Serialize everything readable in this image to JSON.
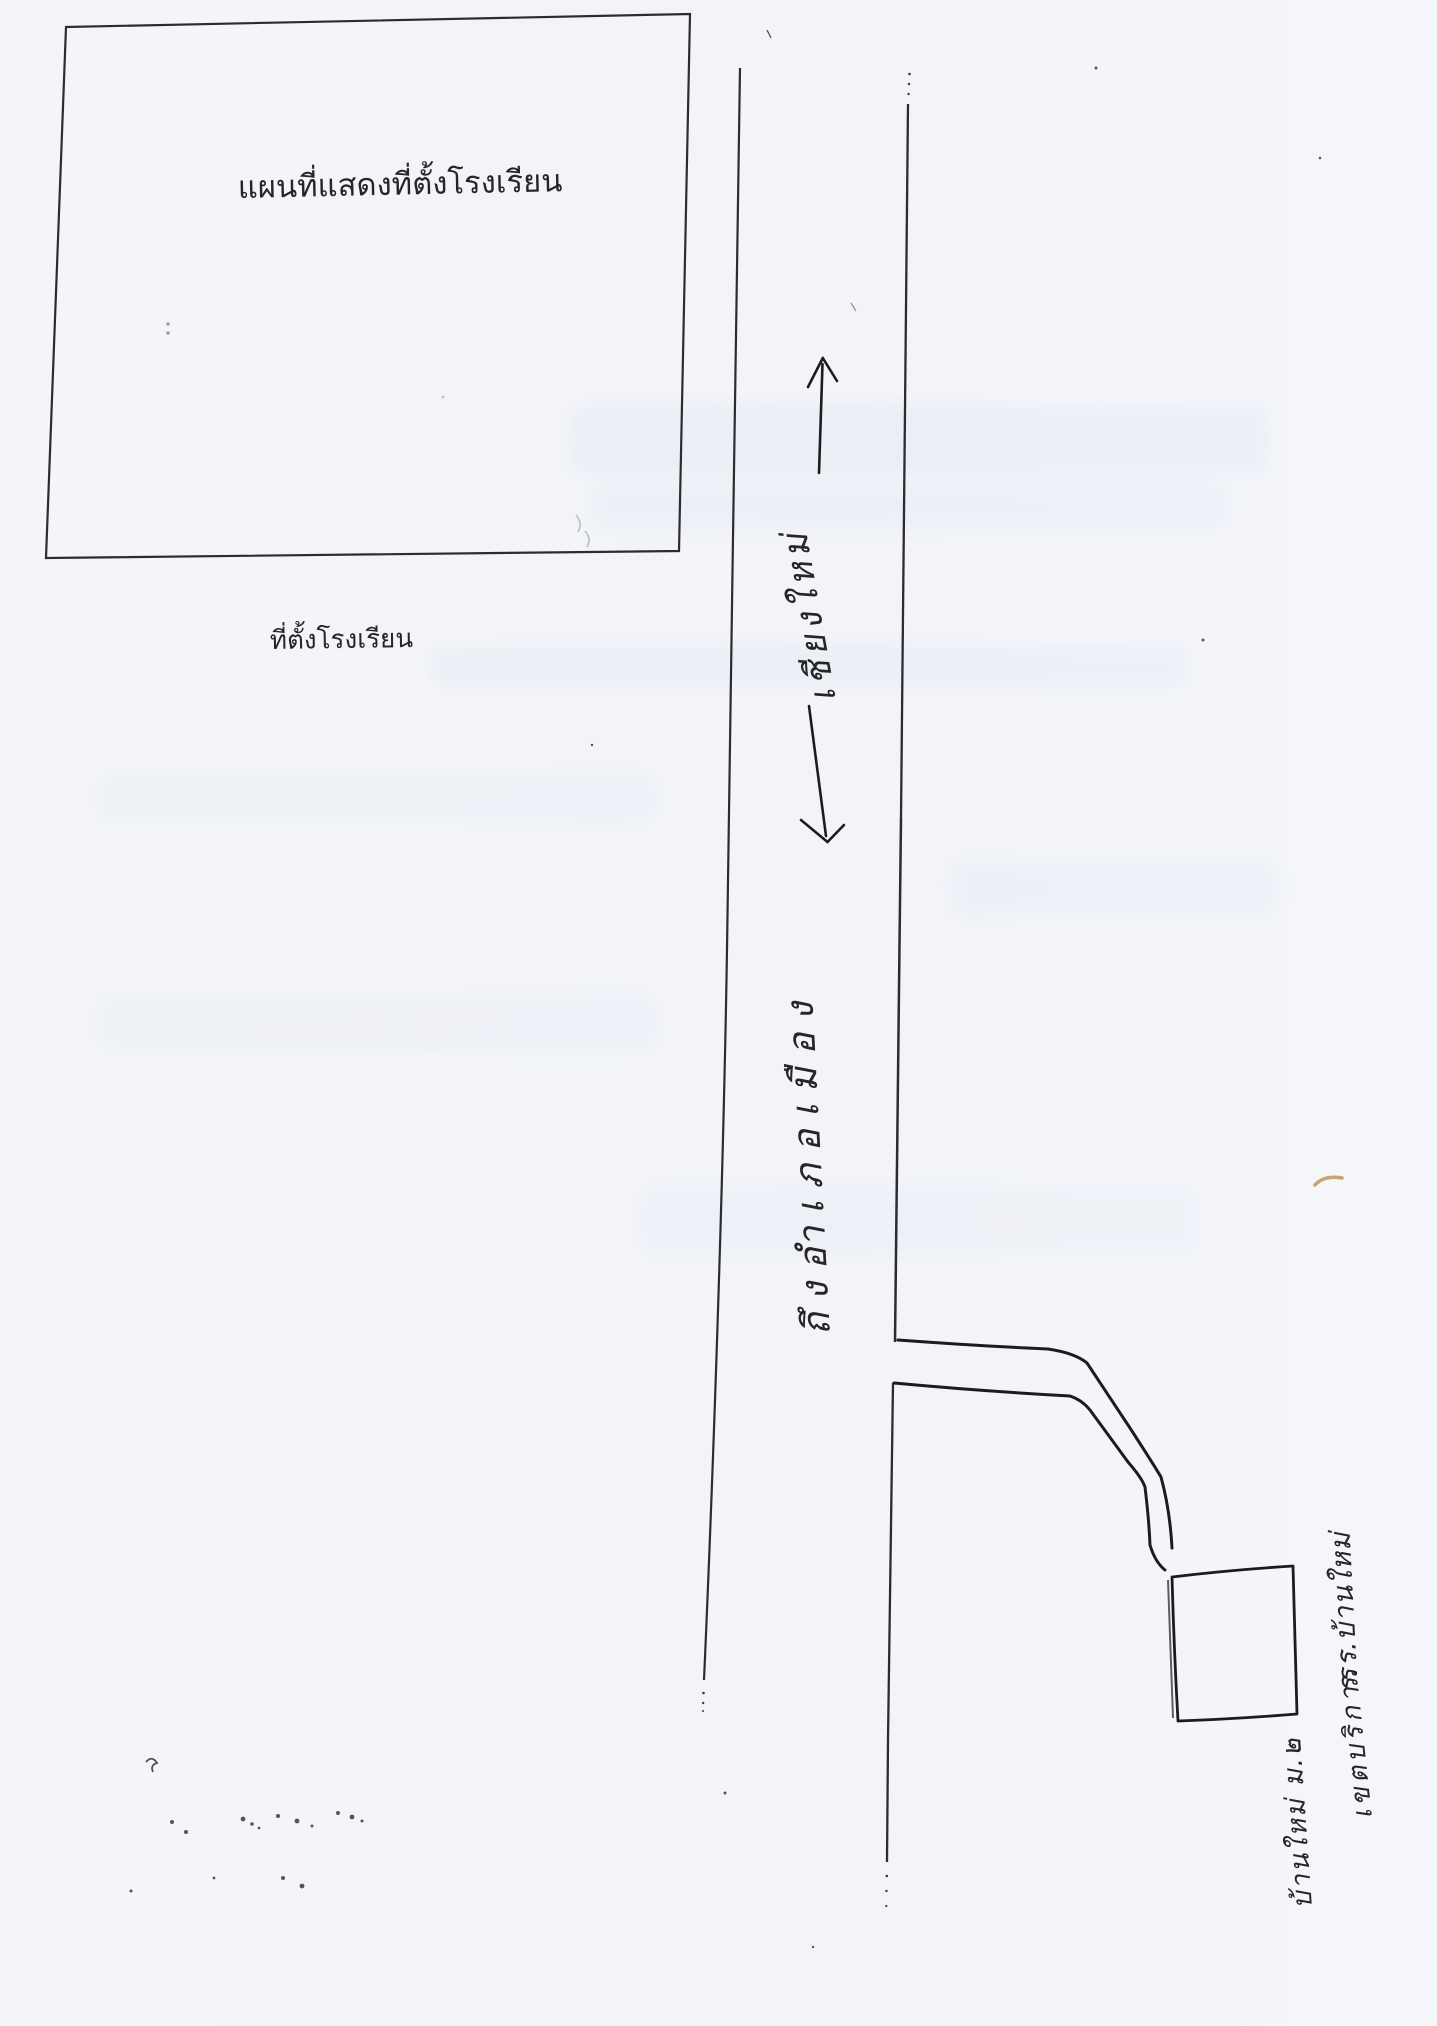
{
  "document": {
    "map_frame_title": "แผนที่แสดงที่ตั้งโรงเรียน",
    "location_label": "ที่ตั้งโรงเรียน"
  },
  "road": {
    "north_label": "เชียงใหม่",
    "south_label": "ถึงอำเภอเมือง",
    "north_arrow_icon": "arrow-up",
    "south_arrow_icon": "arrow-down"
  },
  "school": {
    "building_label": "ร.ร.บ้านใหม่",
    "note_line1": "เขตบริการ",
    "note_line2": "บ้านใหม่ ม.๒"
  },
  "colors": {
    "paper": "#f2f4f9",
    "ink": "#2c2c2e",
    "pen": "#1c1c1c",
    "accent_orange": "#bf8742"
  }
}
